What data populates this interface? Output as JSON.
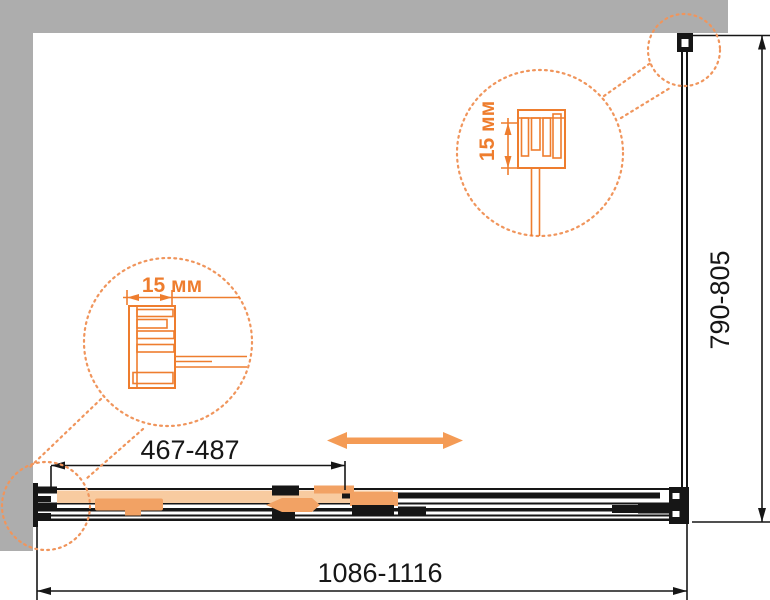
{
  "drawing": {
    "type": "shower-enclosure-top-view-technical-drawing",
    "dims": {
      "door_adjust": "467-487",
      "overall_width": "1086-1116",
      "side_depth": "790-805",
      "left_detail": "15 мм",
      "right_detail": "15 мм"
    },
    "colors": {
      "wall": "#ADADAD",
      "ink": "#161616",
      "orange": "#EE7D2E",
      "orange_dots": "#F0955C",
      "door_fill": "#F8CBA0",
      "hardware": "#F2A264",
      "arrow": "#F49B55"
    }
  }
}
